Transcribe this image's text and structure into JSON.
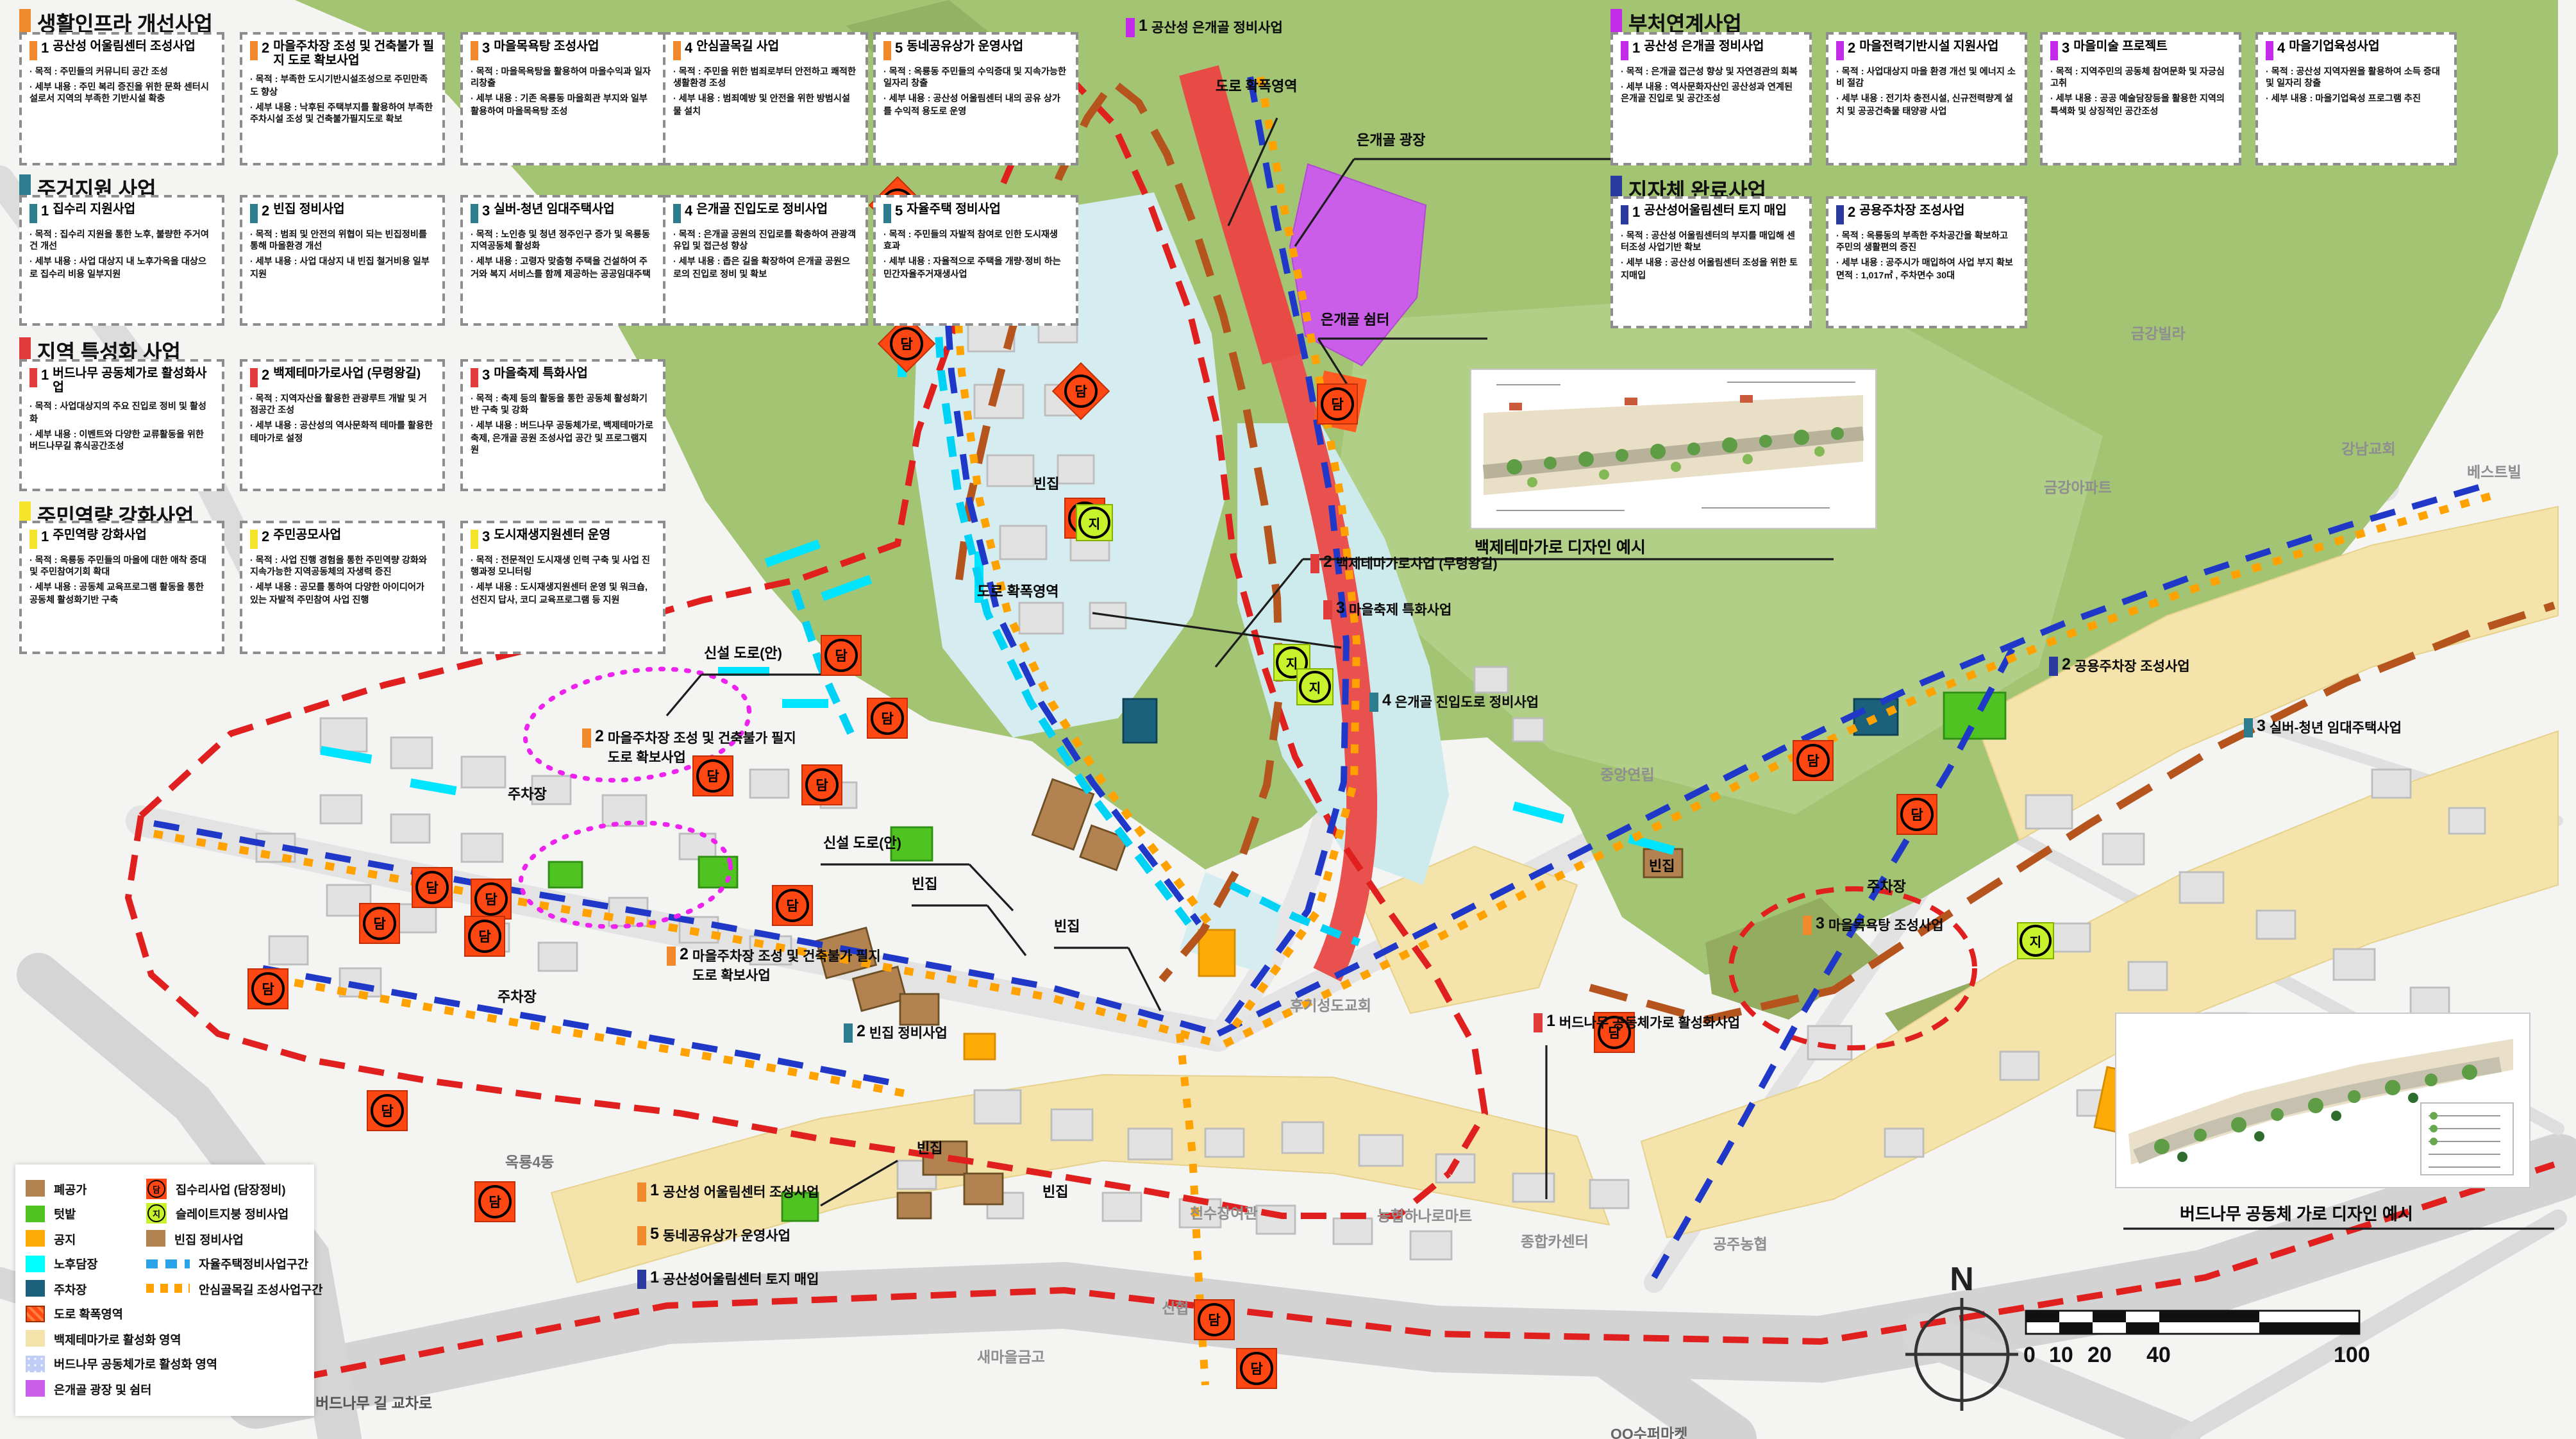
{
  "sections": [
    {
      "title": "생활인프라 개선사업",
      "accent": "#f08a2c",
      "cards": [
        {
          "num": "1",
          "title": "공산성 어울림센터 조성사업",
          "purpose": "· 목적 : 주민들의 커뮤니티 공간 조성",
          "detail": "· 세부 내용 : 주민 복리 증진을 위한 문화 센터시설로서 지역의 부족한 기반시설 확충"
        },
        {
          "num": "2",
          "title": "마을주차장 조성 및 건축불가 필지 도로 확보사업",
          "purpose": "· 목적 : 부족한 도시기반시설조성으로 주민만족도 향상",
          "detail": "· 세부 내용 : 낙후된 주택부지를 활용하여 부족한 주차시설 조성 및 건축불가필지도로 확보"
        },
        {
          "num": "3",
          "title": "마을목욕탕 조성사업",
          "purpose": "· 목적 : 마을목욕탕을 활용하여 마을수익과 일자리창출",
          "detail": "· 세부 내용 : 기존 옥룡동 마을회관 부지와 일부 활용하여 마을목욕탕 조성"
        },
        {
          "num": "4",
          "title": "안심골목길 사업",
          "purpose": "· 목적 : 주민을 위한 범죄로부터 안전하고 쾌적한 생활환경 조성",
          "detail": "· 세부 내용 : 범죄예방 및 안전을 위한 방범시설물 설치"
        },
        {
          "num": "5",
          "title": "동네공유상가 운영사업",
          "purpose": "· 목적 : 옥룡동 주민들의 수익증대 및 지속가능한 일자리 창출",
          "detail": "· 세부 내용 : 공산성 어울림센터 내의 공유 상가를 수익적 용도로 운영"
        }
      ]
    },
    {
      "title": "주거지원 사업",
      "accent": "#2e7d8e",
      "cards": [
        {
          "num": "1",
          "title": "집수리 지원사업",
          "purpose": "· 목적 : 집수리 지원을 통한 노후, 불량한 주거여건 개선",
          "detail": "· 세부 내용 : 사업 대상지 내 노후가옥을 대상으로 집수리 비용 일부지원"
        },
        {
          "num": "2",
          "title": "빈집 정비사업",
          "purpose": "· 목적 : 범죄 및 안전의 위협이 되는 빈집정비를 통해 마을환경 개선",
          "detail": "· 세부 내용 : 사업 대상지 내 빈집 철거비용 일부지원"
        },
        {
          "num": "3",
          "title": "실버-청년 임대주택사업",
          "purpose": "· 목적 : 노인층 및 청년 정주인구 증가 및 옥룡동 지역공동체 활성화",
          "detail": "· 세부 내용 : 고령자 맞춤형 주택을 건설하여 주거와 복지 서비스를 함께 제공하는 공공임대주택"
        },
        {
          "num": "4",
          "title": "은개골 진입도로 정비사업",
          "purpose": "· 목적 : 은개골 공원의 진입로를 확충하여 관광객 유입 및 접근성 향상",
          "detail": "· 세부 내용 : 좁은 길을 확장하여 은개골 공원으로의 진입로 정비 및 확보"
        },
        {
          "num": "5",
          "title": "자율주택 정비사업",
          "purpose": "· 목적 : 주민들의 자발적 참여로 인한 도시재생 효과",
          "detail": "· 세부 내용 : 자율적으로 주택을 개량·정비 하는 민간자율주거재생사업"
        }
      ]
    },
    {
      "title": "지역 특성화 사업",
      "accent": "#e23b3b",
      "cards": [
        {
          "num": "1",
          "title": "버드나무 공동체가로 활성화사업",
          "purpose": "· 목적 : 사업대상지의 주요 진입로 정비 및 활성화",
          "detail": "· 세부 내용 : 이벤트와 다양한 교류활동을 위한 버드나무길 휴식공간조성"
        },
        {
          "num": "2",
          "title": "백제테마가로사업 (무령왕길)",
          "purpose": "· 목적 : 지역자산을 활용한 관광루트 개발 및 거점공간 조성",
          "detail": "· 세부 내용 : 공산성의 역사문화적 테마를 활용한 테마가로 설정"
        },
        {
          "num": "3",
          "title": "마을축제 특화사업",
          "purpose": "· 목적 : 축제 등의 활동을 통한 공동체 활성화기반 구축 및 강화",
          "detail": "· 세부 내용 : 버드나무 공동체가로, 백제테마가로축제, 은개골 공원 조성사업 공간 및 프로그램지원"
        }
      ]
    },
    {
      "title": "주민역량 강화사업",
      "accent": "#f6e32b",
      "cards": [
        {
          "num": "1",
          "title": "주민역량 강화사업",
          "purpose": "· 목적 : 옥룡동 주민들의 마을에 대한 애착 증대 및 주민참여기회 확대",
          "detail": "· 세부 내용 : 공동체 교육프로그램 활동을 통한 공동체 활성화기반 구축"
        },
        {
          "num": "2",
          "title": "주민공모사업",
          "purpose": "· 목적 : 사업 진행 경험을 통한 주민역량 강화와 지속가능한 지역공동체의 자생력 증진",
          "detail": "· 세부 내용 : 공모를 통하여 다양한 아이디어가 있는 자발적 주민참여 사업 진행"
        },
        {
          "num": "3",
          "title": "도시재생지원센터 운영",
          "purpose": "· 목적 : 전문적인 도시재생 인력 구축 및 사업 진행과정 모니터링",
          "detail": "· 세부 내용 : 도시재생지원센터 운영 및 워크숍, 선진지 답사, 코디 교육프로그램 등 지원"
        }
      ]
    },
    {
      "title": "부처연계사업",
      "accent": "#c32bea",
      "cards": [
        {
          "num": "1",
          "title": "공산성 은개골 정비사업",
          "purpose": "· 목적 : 은개골 접근성 향상 및 자연경관의 회복",
          "detail": "· 세부 내용 : 역사문화자산인 공산성과 연계된 은개골 진입로 및 공간조성"
        },
        {
          "num": "2",
          "title": "마을전력기반시설 지원사업",
          "purpose": "· 목적 : 사업대상지 마을 환경 개선 및 에너지 소비 절감",
          "detail": "· 세부 내용 : 전기차 충전시설, 신규전력량계 설치 및 공공건축물 태양광 사업"
        },
        {
          "num": "3",
          "title": "마을미술 프로젝트",
          "purpose": "· 목적 : 지역주민의 공동체 참여문화 및 자긍심 고취",
          "detail": "· 세부 내용 : 공공 예술담장등을 활용한 지역의 특색화 및 상징적인 공간조성"
        },
        {
          "num": "4",
          "title": "마을기업육성사업",
          "purpose": "· 목적 : 공산성 지역자원을 활용하여 소득 증대 및 일자리 창출",
          "detail": "· 세부 내용 : 마을기업육성 프로그램 추진"
        }
      ]
    },
    {
      "title": "지자체 완료사업",
      "accent": "#2a3a9f",
      "cards": [
        {
          "num": "1",
          "title": "공산성어울림센터 토지 매입",
          "purpose": "· 목적 : 공산성 어울림센터의 부지를 매입해 센터조성 사업기반 확보",
          "detail": "· 세부 내용 : 공산성 어울림센터 조성을 위한 토지매입"
        },
        {
          "num": "2",
          "title": "공용주차장 조성사업",
          "purpose": "· 목적 : 옥룡동의 부족한 주차공간을 확보하고 주민의 생활편의 증진",
          "detail": "· 세부 내용 : 공주시가 매입하여 사업 부지 확보  면적 : 1,017㎡ , 주차면수 30대"
        }
      ]
    }
  ],
  "legend": {
    "areas": [
      {
        "label": "폐공가",
        "color": "#b28350"
      },
      {
        "label": "텃밭",
        "color": "#4ec321"
      },
      {
        "label": "공지",
        "color": "#ffab07"
      },
      {
        "label": "노후담장",
        "color": "#00ffff"
      },
      {
        "label": "주차장",
        "color": "#1b617b"
      },
      {
        "label": "도로 확폭영역",
        "color": "#ff4b12"
      },
      {
        "label": "백제테마가로 활성화 영역",
        "color": "#f4e3ab"
      },
      {
        "label": "버드나무 공동체가로 활성화 영역",
        "color": "#c0cdf6"
      },
      {
        "label": "은개골 광장 및 쉼터",
        "color": "#cb5ee9"
      }
    ],
    "projects": [
      {
        "label": "집수리사업 (담장정비)",
        "color": "#ff4713"
      },
      {
        "label": "슬레이트지붕 정비사업",
        "color": "#c8f22c"
      },
      {
        "label": "빈집 정비사업",
        "color": "#b28350"
      },
      {
        "label": "자율주택정비사업구간",
        "color": "#2aa3e8"
      },
      {
        "label": "안심골목길 조성사업구간",
        "color": "#ffa200"
      }
    ]
  },
  "map": {
    "badges": {
      "dam": "담",
      "ji": "지"
    },
    "terms": {
      "road_widen": "도로 확폭영역",
      "plaza": "은개골 광장",
      "shelter": "은개골 쉼터",
      "new_road": "신설 도로(안)",
      "parking": "주차장",
      "vacant": "빈집"
    },
    "captions": {
      "theme": "백제테마가로 디자인 예시",
      "willow": "버드나무 공동체 가로 디자인 예시"
    },
    "projects": {
      "p1": {
        "num": "1",
        "text": "공산성 은개골 정비사업",
        "color": "#c32bea"
      },
      "p2": {
        "num": "2",
        "text": "백제테마가로사업 (무령왕길)",
        "color": "#e23b3b"
      },
      "p3": {
        "num": "3",
        "text": "마을축제 특화사업",
        "color": "#e23b3b"
      },
      "p4": {
        "num": "4",
        "text": "은개골 진입도로 정비사업",
        "color": "#2e7d8e"
      },
      "p5": {
        "num": "2",
        "text": "마을주차장 조성 및 건축불가 필지 도로 확보사업",
        "color": "#f08a2c"
      },
      "p6": {
        "num": "2",
        "text": "빈집 정비사업",
        "color": "#2e7d8e"
      },
      "p7": {
        "num": "1",
        "text": "버드나무 공동체가로 활성화사업",
        "color": "#e23b3b"
      },
      "p8": {
        "num": "3",
        "text": "마을목욕탕 조성사업",
        "color": "#f08a2c"
      },
      "p9": {
        "num": "2",
        "text": "공용주차장 조성사업",
        "color": "#2a3a9f"
      },
      "p10": {
        "num": "3",
        "text": "실버-청년 임대주택사업",
        "color": "#2e7d8e"
      },
      "p11": {
        "num": "1",
        "text": "공산성 어울림센터 조성사업",
        "color": "#f08a2c"
      },
      "p12": {
        "num": "5",
        "text": "동네공유상가 운영사업",
        "color": "#f08a2c"
      },
      "p13": {
        "num": "1",
        "text": "공산성어울림센터 토지 매입",
        "color": "#2a3a9f"
      }
    },
    "places": {
      "geumgang_villa": "금강빌라",
      "gangnam_church": "강남교회",
      "bestville": "베스트빌",
      "geumgang_apt": "금강아파트",
      "jungang": "중앙연립",
      "hugi_church": "후기성도교회",
      "cheonsu_inn": "천수장여관",
      "car_center": "종합카센터",
      "hanaro_mart": "농협하나로마트",
      "gongju_nh": "공주농협",
      "shinhyup": "신협",
      "saemaul": "새마을금고",
      "okryong": "옥룡4동",
      "willow_cross": "버드나무 길 교차로",
      "supermarket": "OO수퍼마켓"
    },
    "compass": "N",
    "scalebar": [
      "0",
      "10",
      "20",
      "40",
      "100"
    ]
  }
}
